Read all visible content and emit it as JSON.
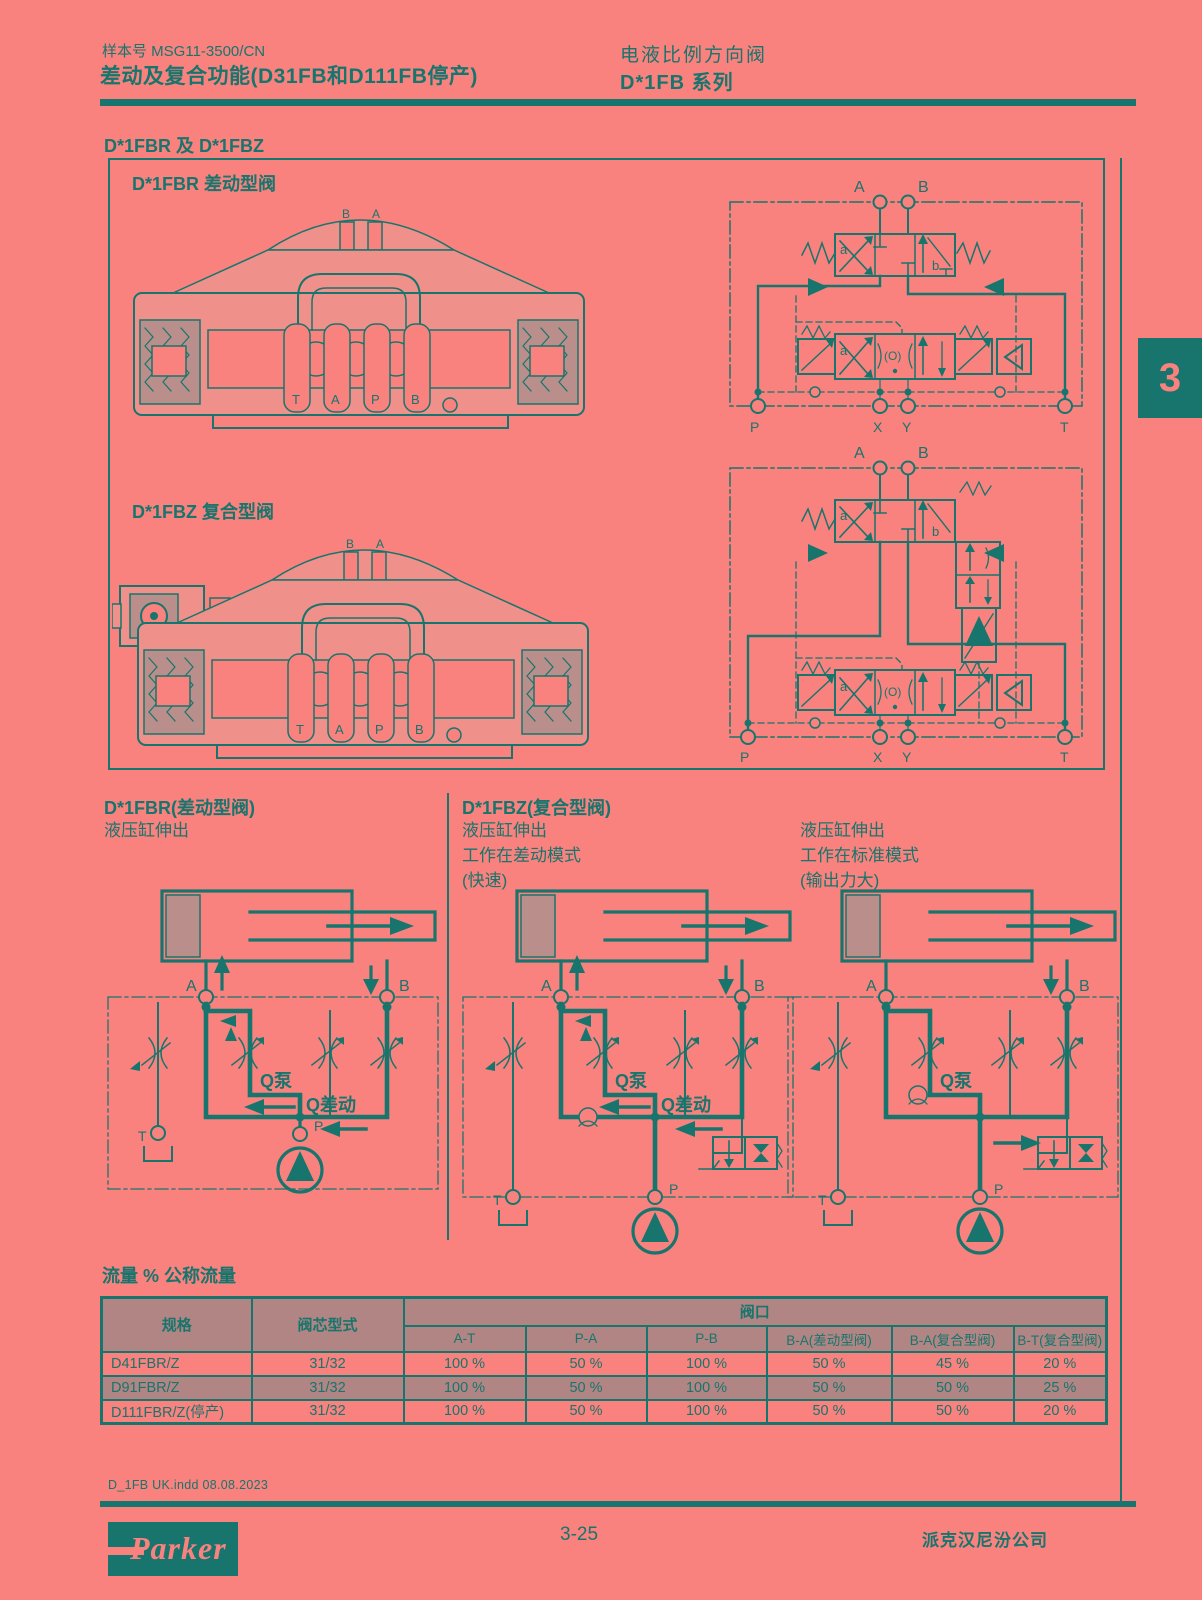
{
  "header": {
    "doc_number": "样本号 MSG11-3500/CN",
    "title": "差动及复合功能(D31FB和D111FB停产)",
    "product_line1": "电液比例方向阀",
    "product_line2": "D*1FB 系列"
  },
  "side_tab": "3",
  "section": {
    "title": "D*1FBR 及 D*1FBZ",
    "fbr_label": "D*1FBR 差动型阀",
    "fbz_label": "D*1FBZ 复合型阀"
  },
  "cross": {
    "top": [
      "B",
      "A"
    ],
    "bottom": [
      "T",
      "A",
      "P",
      "B"
    ]
  },
  "sch": {
    "top": [
      "A",
      "B"
    ],
    "bottom": [
      "P",
      "X",
      "Y",
      "T"
    ],
    "cells": {
      "a": "a",
      "b": "b",
      "o": "(O)"
    }
  },
  "circuits": {
    "common": {
      "a": "A",
      "b": "B",
      "p": "P",
      "t": "T",
      "q_pump": "Q泵",
      "q_diff": "Q差动"
    },
    "col1": {
      "title": "D*1FBR(差动型阀)",
      "lines": [
        "液压缸伸出"
      ]
    },
    "col2": {
      "title": "D*1FBZ(复合型阀)",
      "lines": [
        "液压缸伸出",
        "工作在差动模式",
        "(快速)"
      ]
    },
    "col3": {
      "lines": [
        "液压缸伸出",
        "工作在标准模式",
        "(输出力大)"
      ]
    }
  },
  "table": {
    "title": "流量 % 公称流量",
    "col_spec": "规格",
    "col_spool": "阀芯型式",
    "col_group": "阀口",
    "port_cols": [
      "A-T",
      "P-A",
      "P-B",
      "B-A(差动型阀)",
      "B-A(复合型阀)",
      "B-T(复合型阀)"
    ],
    "rows": [
      {
        "spec": "D41FBR/Z",
        "spool": "31/32",
        "values": [
          "100 %",
          "50 %",
          "100 %",
          "50 %",
          "45 %",
          "20 %"
        ]
      },
      {
        "spec": "D91FBR/Z",
        "spool": "31/32",
        "values": [
          "100 %",
          "50 %",
          "100 %",
          "50 %",
          "50 %",
          "25 %"
        ]
      },
      {
        "spec": "D111FBR/Z(停产)",
        "spool": "31/32",
        "values": [
          "100 %",
          "50 %",
          "100 %",
          "50 %",
          "50 %",
          "20 %"
        ]
      }
    ]
  },
  "footer": {
    "file_info": "D_1FB UK.indd 08.08.2023",
    "page_number": "3-25",
    "company": "派克汉尼汾公司",
    "logo": "Parker"
  }
}
